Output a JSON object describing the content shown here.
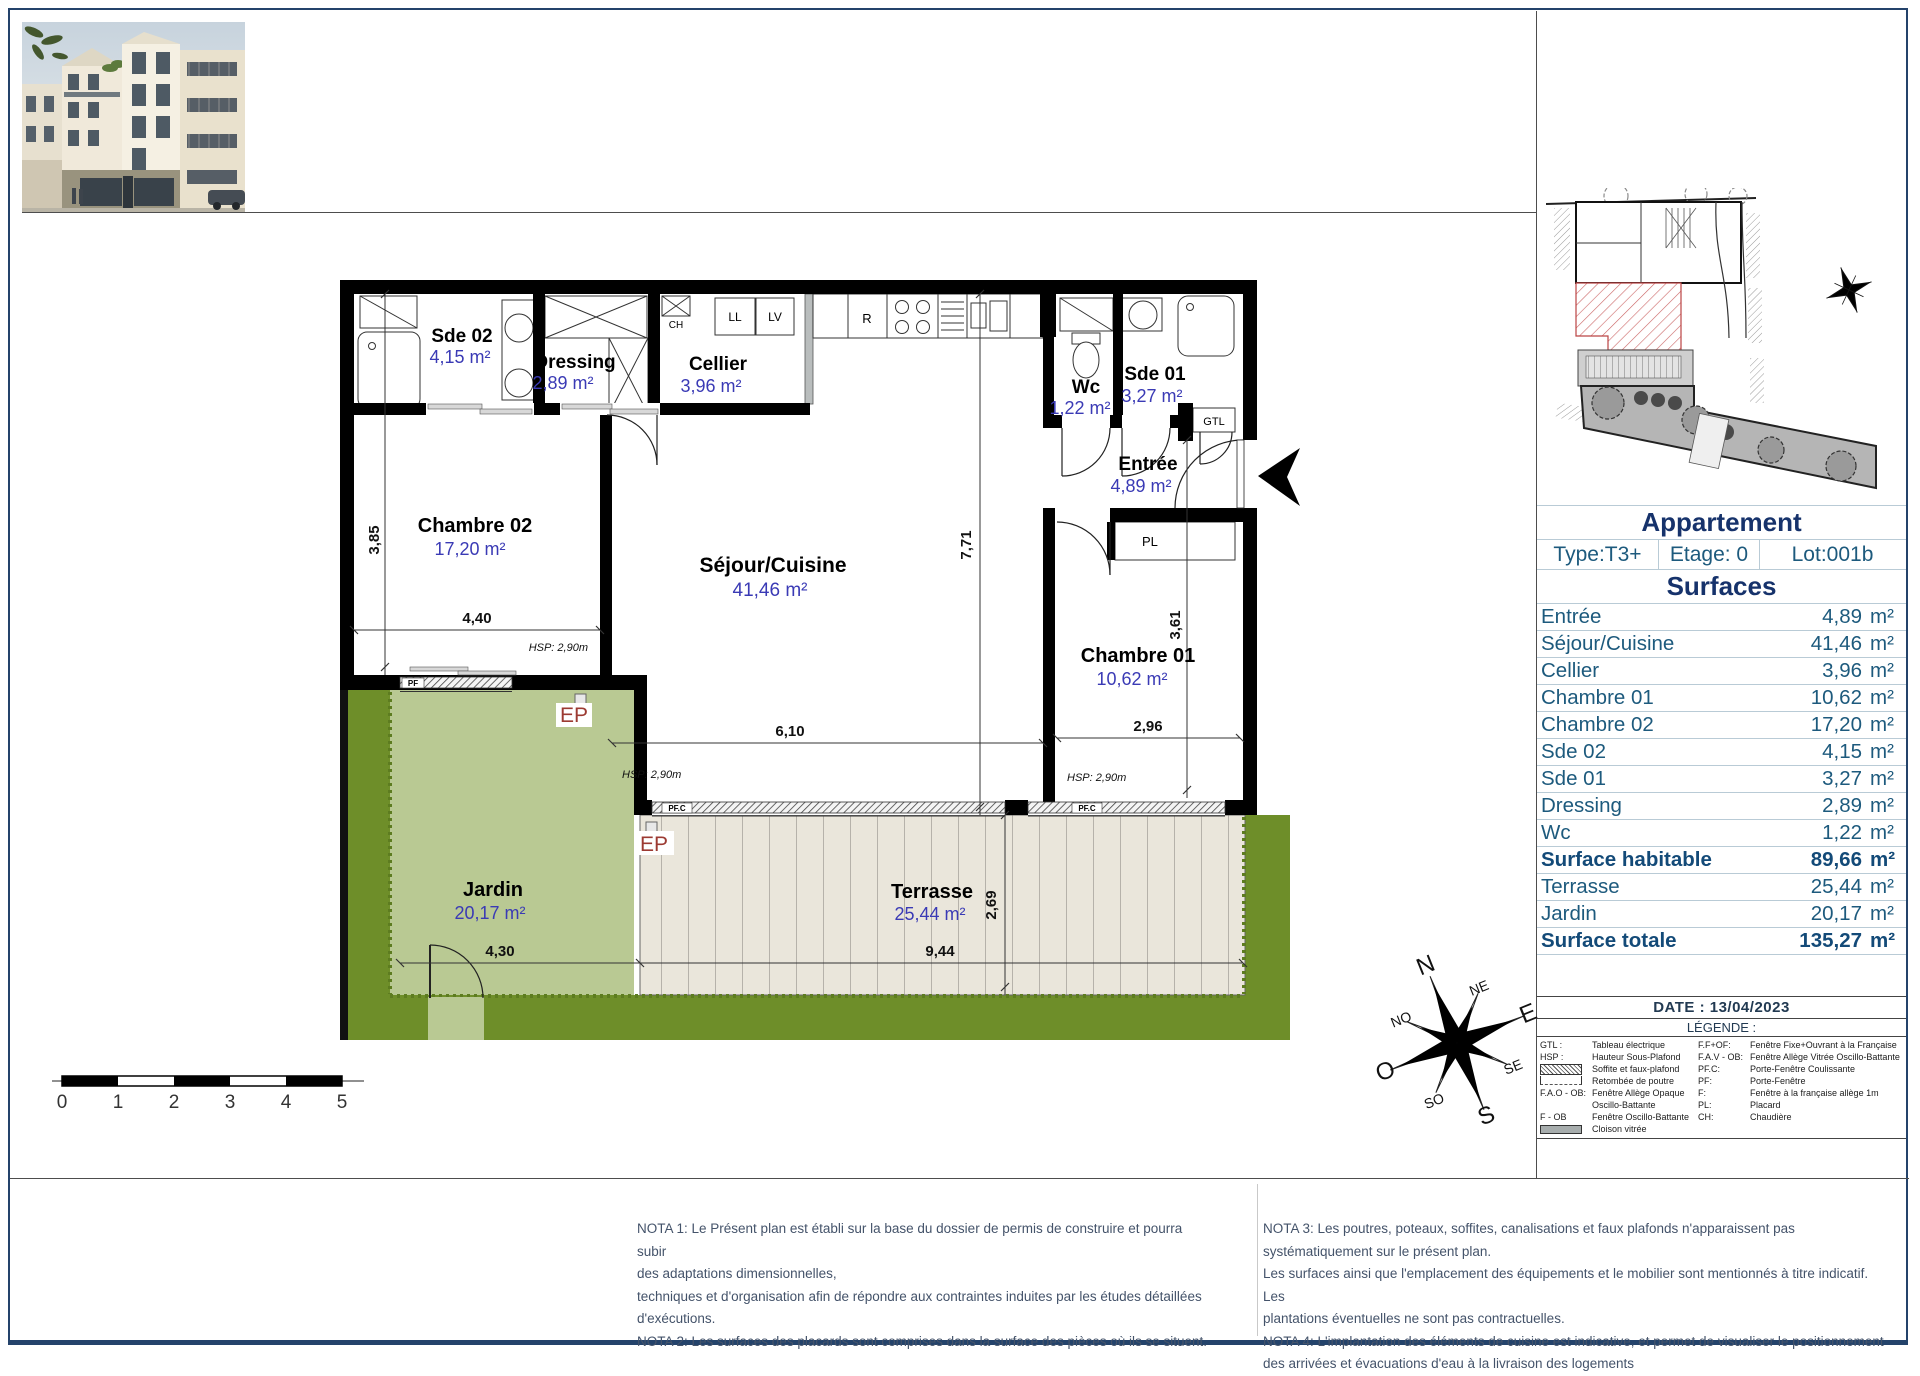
{
  "plan": {
    "rooms": [
      {
        "name": "Sde 02",
        "area": "4,15 m²"
      },
      {
        "name": "Dressing",
        "area": "2,89 m²"
      },
      {
        "name": "Cellier",
        "area": "3,96 m²"
      },
      {
        "name": "Wc",
        "area": "1,22 m²"
      },
      {
        "name": "Sde 01",
        "area": "3,27 m²"
      },
      {
        "name": "Entrée",
        "area": "4,89 m²"
      },
      {
        "name": "Chambre 02",
        "area": "17,20 m²"
      },
      {
        "name": "Séjour/Cuisine",
        "area": "41,46 m²"
      },
      {
        "name": "Chambre 01",
        "area": "10,62 m²"
      },
      {
        "name": "Jardin",
        "area": "20,17 m²"
      },
      {
        "name": "Terrasse",
        "area": "25,44 m²"
      }
    ],
    "dims": {
      "chambre02_width": "4,40",
      "chambre02_height": "3,85",
      "sejour_height": "7,71",
      "sejour_width": "6,10",
      "chambre01_height": "3,61",
      "chambre01_width": "2,96",
      "jardin_width": "4,30",
      "terrasse_width": "9,44",
      "terrasse_height": "2,69"
    },
    "hsp": "HSP: 2,90m",
    "labels": {
      "pf": "PF",
      "pfc": "PF.C",
      "pl": "PL",
      "gtl": "GTL",
      "ch": "CH",
      "ll": "LL",
      "lv": "LV",
      "r": "R",
      "ep": "EP"
    }
  },
  "sidebar": {
    "title": "Appartement",
    "type": "Type:T3+",
    "etage": "Etage: 0",
    "lot": "Lot:001b",
    "surfaces_title": "Surfaces",
    "unit": "m²",
    "rows": [
      {
        "label": "Entrée",
        "value": "4,89"
      },
      {
        "label": "Séjour/Cuisine",
        "value": "41,46"
      },
      {
        "label": "Cellier",
        "value": "3,96"
      },
      {
        "label": "Chambre 01",
        "value": "10,62"
      },
      {
        "label": "Chambre 02",
        "value": "17,20"
      },
      {
        "label": "Sde 02",
        "value": "4,15"
      },
      {
        "label": "Sde 01",
        "value": "3,27"
      },
      {
        "label": "Dressing",
        "value": "2,89"
      },
      {
        "label": "Wc",
        "value": "1,22"
      },
      {
        "label": "Surface habitable",
        "value": "89,66"
      },
      {
        "label": "Terrasse",
        "value": "25,44"
      },
      {
        "label": "Jardin",
        "value": "20,17"
      },
      {
        "label": "Surface totale",
        "value": "135,27"
      }
    ]
  },
  "legend": {
    "date": "DATE : 13/04/2023",
    "title": "LÉGENDE :",
    "left": [
      {
        "abbr": "GTL :",
        "desc": "Tableau électrique"
      },
      {
        "abbr": "HSP :",
        "desc": "Hauteur Sous-Plafond"
      },
      {
        "abbr": "",
        "desc": "Soffite et faux-plafond"
      },
      {
        "abbr": "",
        "desc": "Retombée de poutre"
      },
      {
        "abbr": "F.A.O - OB:",
        "desc": "Fenêtre Allège Opaque"
      },
      {
        "abbr": "",
        "desc": "Oscillo-Battante"
      },
      {
        "abbr": "F - OB",
        "desc": "Fenêtre Oscillo-Battante"
      },
      {
        "abbr": "",
        "desc": "Cloison vitrée"
      }
    ],
    "right": [
      {
        "abbr": "F.F+OF:",
        "desc": "Fenêtre Fixe+Ouvrant à la Française"
      },
      {
        "abbr": "F.A.V - OB:",
        "desc": "Fenêtre Allège Vitrée Oscillo-Battante"
      },
      {
        "abbr": "PF.C:",
        "desc": "Porte-Fenêtre Coulissante"
      },
      {
        "abbr": "PF:",
        "desc": "Porte-Fenêtre"
      },
      {
        "abbr": "F:",
        "desc": "Fenêtre à la française allège 1m"
      },
      {
        "abbr": "PL:",
        "desc": "Placard"
      },
      {
        "abbr": "CH:",
        "desc": "Chaudière"
      }
    ]
  },
  "scalebar": {
    "ticks": [
      "0",
      "1",
      "2",
      "3",
      "4",
      "5"
    ]
  },
  "compass": {
    "points": [
      "N",
      "NE",
      "E",
      "SE",
      "S",
      "SO",
      "O",
      "NO"
    ]
  },
  "notes": {
    "left": [
      "NOTA 1: Le Présent plan est établi sur la base du dossier de permis de construire et pourra subir",
      "des adaptations dimensionnelles,",
      "techniques et d'organisation afin de répondre aux contraintes induites par les études détaillées",
      "d'exécutions.",
      "NOTA 2: Les surfaces des placards sont comprises dans la surface des pièces où ils se situent."
    ],
    "right": [
      "NOTA 3: Les poutres, poteaux, soffites, canalisations et faux plafonds n'apparaissent pas",
      "systématiquement sur le présent plan.",
      "Les surfaces ainsi que l'emplacement des équipements et le mobilier sont mentionnés à titre indicatif. Les",
      "plantations éventuelles ne sont pas contractuelles.",
      "NOTA 4: L'implantation des éléments de cuisine est indicative, et permet de visualiser le positionnement",
      "des arrivées et évacuations d'eau à la livraison des logements"
    ]
  }
}
